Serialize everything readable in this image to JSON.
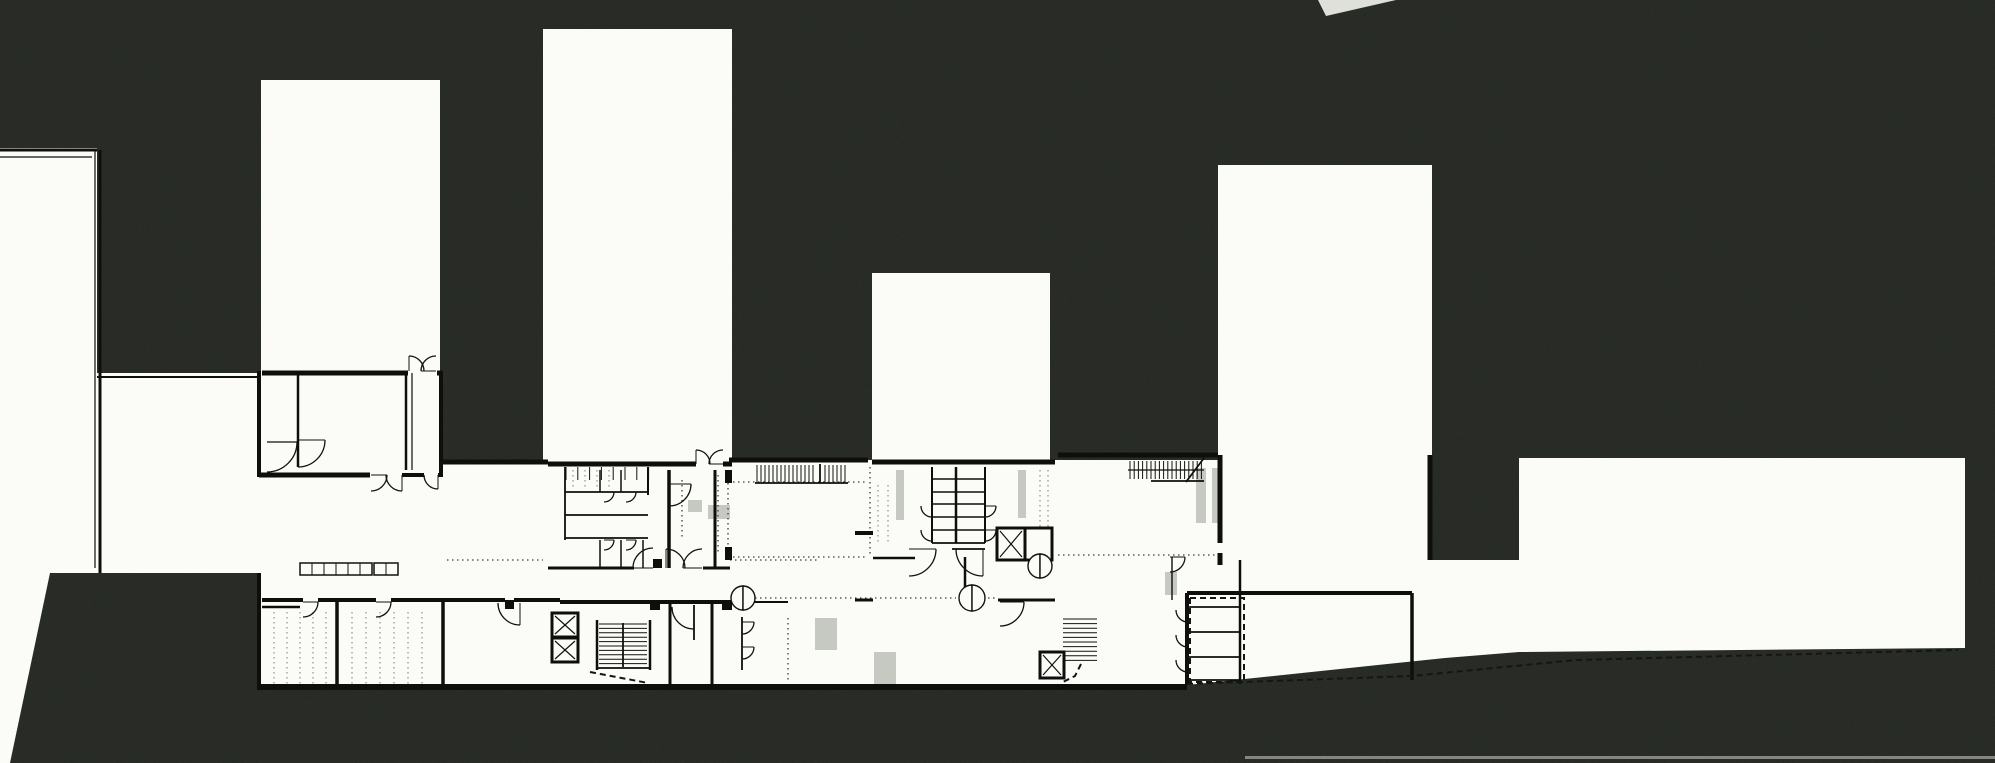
{
  "meta": {
    "canvas": {
      "width": 1995,
      "height": 763
    },
    "drawing_type": "architectural-site-floor-plan"
  },
  "palette": {
    "background": "#31352f",
    "paper": "#fbfbf7",
    "line": "#111310",
    "wall": "#0e0f0d",
    "dotted": "#3c3e39",
    "dotted_light": "#8f928a",
    "gray_fixture": "#c6c9c2",
    "dashed": "#151613",
    "notch": "#dfe0d9",
    "scanline": "#9a9d95"
  },
  "plan": {
    "masses": [
      {
        "name": "left-neighbor-building",
        "pts": [
          [
            0,
            148
          ],
          [
            97,
            148
          ],
          [
            97,
            373
          ],
          [
            259,
            373
          ],
          [
            259,
            573
          ],
          [
            50,
            573
          ],
          [
            10,
            763
          ],
          [
            0,
            763
          ]
        ]
      },
      {
        "name": "tower-1-with-wing",
        "pts": [
          [
            261,
            80
          ],
          [
            440,
            80
          ],
          [
            440,
            371
          ],
          [
            443,
            371
          ],
          [
            443,
            477
          ],
          [
            258,
            477
          ],
          [
            258,
            371
          ],
          [
            261,
            371
          ]
        ]
      },
      {
        "name": "tower-2",
        "rect": [
          543,
          29,
          189,
          433
        ]
      },
      {
        "name": "tower-3",
        "rect": [
          872,
          273,
          178,
          189
        ]
      },
      {
        "name": "tower-4",
        "rect": [
          1218,
          165,
          214,
          395
        ]
      },
      {
        "name": "ground-floor-band",
        "pts": [
          [
            258,
            477
          ],
          [
            443,
            477
          ],
          [
            443,
            460
          ],
          [
            1432,
            460
          ],
          [
            1432,
            560
          ],
          [
            1519,
            560
          ],
          [
            1519,
            652
          ],
          [
            1445,
            658
          ],
          [
            1187,
            685
          ],
          [
            258,
            690
          ]
        ]
      },
      {
        "name": "right-low-building",
        "pts": [
          [
            1519,
            458
          ],
          [
            1965,
            458
          ],
          [
            1965,
            648
          ],
          [
            1519,
            652
          ]
        ]
      }
    ],
    "gray_fixtures": [
      [
        896,
        470,
        8,
        50
      ],
      [
        1018,
        470,
        8,
        48
      ],
      [
        1165,
        572,
        12,
        23
      ],
      [
        1196,
        468,
        10,
        55
      ],
      [
        1212,
        468,
        10,
        55
      ],
      [
        815,
        618,
        22,
        32
      ],
      [
        874,
        652,
        22,
        32
      ],
      [
        688,
        500,
        14,
        12
      ],
      [
        708,
        505,
        22,
        14
      ]
    ],
    "dotted_light": [
      [
        274,
        612,
        274,
        685
      ],
      [
        287,
        612,
        287,
        685
      ],
      [
        300,
        612,
        300,
        685
      ],
      [
        313,
        612,
        313,
        685
      ],
      [
        326,
        612,
        326,
        685
      ],
      [
        352,
        612,
        352,
        685
      ],
      [
        366,
        612,
        366,
        685
      ],
      [
        380,
        612,
        380,
        685
      ],
      [
        394,
        612,
        394,
        685
      ],
      [
        408,
        612,
        408,
        685
      ],
      [
        422,
        612,
        422,
        685
      ],
      [
        878,
        485,
        878,
        545
      ],
      [
        888,
        485,
        888,
        545
      ],
      [
        1040,
        470,
        1040,
        545
      ],
      [
        1048,
        470,
        1048,
        545
      ],
      [
        573,
        470,
        573,
        488
      ],
      [
        585,
        470,
        585,
        488
      ],
      [
        597,
        470,
        597,
        488
      ],
      [
        609,
        470,
        609,
        488
      ]
    ],
    "dotted": [
      [
        447,
        560,
        543,
        560
      ],
      [
        733,
        557,
        868,
        557
      ],
      [
        733,
        482,
        868,
        482
      ],
      [
        1058,
        555,
        1218,
        555
      ],
      [
        755,
        598,
        956,
        598
      ],
      [
        988,
        598,
        998,
        598
      ],
      [
        682,
        480,
        682,
        537
      ],
      [
        718,
        475,
        718,
        555
      ],
      [
        728,
        483,
        728,
        547
      ],
      [
        870,
        467,
        870,
        556
      ],
      [
        788,
        618,
        788,
        682
      ],
      [
        730,
        560,
        820,
        560
      ]
    ],
    "walls": [
      [
        262,
        373,
        408,
        373,
        5
      ],
      [
        437,
        373,
        443,
        373,
        5
      ],
      [
        259,
        371,
        259,
        477,
        4
      ],
      [
        259,
        475,
        370,
        475,
        5
      ],
      [
        402,
        475,
        424,
        475,
        4
      ],
      [
        438,
        475,
        443,
        475,
        4
      ],
      [
        298,
        373,
        298,
        467,
        2.5
      ],
      [
        406,
        373,
        406,
        470,
        2.5
      ],
      [
        412,
        373,
        412,
        470,
        1.2
      ],
      [
        441,
        371,
        441,
        477,
        4
      ],
      [
        97,
        377,
        259,
        377,
        2
      ],
      [
        0,
        150,
        97,
        150,
        3
      ],
      [
        0,
        157,
        92,
        157,
        1.2
      ],
      [
        95,
        150,
        95,
        568,
        1.2
      ],
      [
        100,
        150,
        100,
        573,
        3
      ],
      [
        259,
        573,
        259,
        690,
        4
      ],
      [
        262,
        600,
        303,
        600,
        4
      ],
      [
        318,
        600,
        376,
        600,
        4
      ],
      [
        391,
        600,
        505,
        600,
        4
      ],
      [
        514,
        600,
        560,
        600,
        4
      ],
      [
        337,
        600,
        337,
        687,
        3.5
      ],
      [
        443,
        600,
        443,
        687,
        3.5
      ],
      [
        262,
        607,
        300,
        607,
        2.5
      ],
      [
        259,
        687,
        1187,
        687,
        6
      ],
      [
        548,
        464,
        696,
        464,
        5
      ],
      [
        723,
        464,
        732,
        464,
        5
      ],
      [
        443,
        462,
        548,
        462,
        5
      ],
      [
        729,
        460,
        868,
        460,
        5
      ],
      [
        872,
        462,
        1055,
        462,
        5
      ],
      [
        1058,
        455,
        1218,
        455,
        5
      ],
      [
        1220,
        455,
        1220,
        543,
        5
      ],
      [
        1220,
        553,
        1220,
        565,
        5
      ],
      [
        1430,
        455,
        1430,
        560,
        5
      ],
      [
        548,
        568,
        634,
        568,
        3
      ],
      [
        703,
        568,
        730,
        568,
        3
      ],
      [
        669,
        470,
        669,
        568,
        3.5
      ],
      [
        715,
        470,
        715,
        568,
        3
      ],
      [
        648,
        467,
        648,
        495,
        2
      ],
      [
        621,
        470,
        621,
        492,
        1.5
      ],
      [
        600,
        470,
        600,
        492,
        1.5
      ],
      [
        565,
        467,
        565,
        540,
        1.8
      ],
      [
        565,
        492,
        648,
        492,
        1.8
      ],
      [
        565,
        515,
        648,
        515,
        1.8
      ],
      [
        565,
        538,
        648,
        538,
        1.8
      ],
      [
        600,
        540,
        600,
        568,
        1.5
      ],
      [
        621,
        540,
        621,
        568,
        1.5
      ],
      [
        643,
        540,
        643,
        568,
        1.5
      ],
      [
        956,
        467,
        956,
        543,
        2.5
      ],
      [
        932,
        467,
        932,
        543,
        2
      ],
      [
        985,
        467,
        985,
        543,
        2
      ],
      [
        932,
        479,
        985,
        479,
        1.4
      ],
      [
        932,
        492,
        985,
        492,
        1.4
      ],
      [
        932,
        504,
        985,
        504,
        1.4
      ],
      [
        932,
        517,
        985,
        517,
        1.4
      ],
      [
        932,
        530,
        985,
        530,
        1.4
      ],
      [
        932,
        543,
        985,
        543,
        1.8
      ],
      [
        873,
        558,
        915,
        558,
        2.5
      ],
      [
        952,
        549,
        985,
        549,
        1.8
      ],
      [
        855,
        600,
        873,
        600,
        3
      ],
      [
        998,
        600,
        1055,
        600,
        3
      ],
      [
        560,
        602,
        650,
        602,
        4
      ],
      [
        660,
        602,
        722,
        602,
        4
      ],
      [
        734,
        602,
        788,
        602,
        2
      ],
      [
        1187,
        593,
        1412,
        593,
        4
      ],
      [
        1187,
        593,
        1187,
        685,
        4
      ],
      [
        1240,
        560,
        1240,
        684,
        2.5
      ],
      [
        1412,
        593,
        1412,
        680,
        3.5
      ],
      [
        1188,
        607,
        1240,
        607,
        1.8
      ],
      [
        1188,
        632,
        1240,
        632,
        1.8
      ],
      [
        1188,
        657,
        1240,
        657,
        1.8
      ],
      [
        1188,
        680,
        1240,
        680,
        1.8
      ],
      [
        597,
        620,
        597,
        670,
        2.5
      ],
      [
        650,
        620,
        650,
        670,
        2.5
      ],
      [
        623,
        623,
        623,
        667,
        1.8
      ],
      [
        597,
        668,
        650,
        668,
        1.8
      ],
      [
        670,
        602,
        670,
        687,
        3
      ],
      [
        694,
        605,
        694,
        640,
        1.8
      ],
      [
        712,
        602,
        712,
        687,
        3
      ],
      [
        742,
        617,
        742,
        670,
        1.8
      ],
      [
        1151,
        481,
        1204,
        481,
        1.8
      ],
      [
        1128,
        470,
        1204,
        470,
        1.2
      ],
      [
        1186,
        482,
        1204,
        458,
        1.8
      ],
      [
        755,
        483,
        848,
        483,
        1.8
      ],
      [
        820,
        464,
        820,
        483,
        1.8
      ],
      [
        855,
        533,
        873,
        533,
        4
      ],
      [
        1172,
        557,
        1172,
        600,
        1.4
      ],
      [
        965,
        557,
        965,
        600,
        2.5
      ],
      [
        267,
        442,
        297,
        442,
        1.2
      ],
      [
        298,
        440,
        298,
        467,
        1.2
      ]
    ],
    "combs": [
      {
        "name": "stair-run",
        "x": 757,
        "y": 465,
        "step": 4,
        "count": 15,
        "len": 17,
        "dir": "v"
      },
      {
        "name": "stair-run",
        "x": 825,
        "y": 465,
        "step": 4,
        "count": 6,
        "len": 17,
        "dir": "v"
      },
      {
        "name": "stair-run",
        "x": 1130,
        "y": 461,
        "step": 4.2,
        "count": 18,
        "len": 18,
        "dir": "v"
      },
      {
        "name": "stair-treads",
        "x": 599,
        "y": 624,
        "step": 4.4,
        "count": 10,
        "len": 48,
        "dir": "h"
      },
      {
        "name": "stair-treads",
        "x": 1063,
        "y": 619,
        "step": 4.6,
        "count": 10,
        "len": 34,
        "dir": "h"
      },
      {
        "name": "stall-partition-ticks",
        "x": 566,
        "y": 467,
        "step": 11.8,
        "count": 8,
        "len": 13,
        "dir": "v"
      }
    ],
    "door_arcs": [
      [
        409,
        371,
        15,
        -90,
        0
      ],
      [
        436,
        371,
        15,
        180,
        270
      ],
      [
        371,
        475,
        16,
        0,
        90
      ],
      [
        402,
        475,
        16,
        90,
        180
      ],
      [
        438,
        475,
        14,
        90,
        180
      ],
      [
        298,
        440,
        27,
        0,
        90
      ],
      [
        267,
        442,
        30,
        0,
        90
      ],
      [
        696,
        464,
        14,
        -90,
        0
      ],
      [
        723,
        464,
        14,
        180,
        270
      ],
      [
        669,
        484,
        22,
        0,
        90
      ],
      [
        909,
        549,
        27,
        0,
        90
      ],
      [
        983,
        549,
        27,
        90,
        180
      ],
      [
        1170,
        557,
        15,
        0,
        90
      ],
      [
        1000,
        602,
        24,
        0,
        90
      ],
      [
        303,
        602,
        15,
        0,
        90
      ],
      [
        376,
        602,
        15,
        0,
        90
      ],
      [
        666,
        568,
        19,
        -90,
        0
      ],
      [
        702,
        568,
        19,
        180,
        270
      ],
      [
        653,
        568,
        20,
        180,
        270
      ],
      [
        604,
        492,
        10,
        0,
        90
      ],
      [
        626,
        492,
        10,
        0,
        90
      ],
      [
        604,
        540,
        10,
        0,
        90
      ],
      [
        626,
        540,
        10,
        0,
        90
      ],
      [
        932,
        506,
        11,
        90,
        180
      ],
      [
        932,
        530,
        11,
        90,
        180
      ],
      [
        985,
        506,
        11,
        0,
        90
      ],
      [
        985,
        530,
        11,
        0,
        90
      ],
      [
        1188,
        610,
        12,
        90,
        180
      ],
      [
        1188,
        635,
        12,
        90,
        180
      ],
      [
        1188,
        660,
        12,
        90,
        180
      ],
      [
        742,
        622,
        12,
        0,
        90
      ],
      [
        742,
        647,
        12,
        0,
        90
      ],
      [
        694,
        607,
        22,
        90,
        180
      ],
      [
        520,
        603,
        22,
        90,
        180
      ]
    ],
    "bowtie_doors": [
      [
        743,
        598,
        12
      ],
      [
        972,
        598,
        13
      ],
      [
        1040,
        566,
        12
      ]
    ],
    "elevators": [
      {
        "x": 552,
        "y": 613,
        "w": 26,
        "h": 24,
        "cross": true
      },
      {
        "x": 552,
        "y": 638,
        "w": 26,
        "h": 24,
        "cross": true
      },
      {
        "x": 997,
        "y": 528,
        "w": 28,
        "h": 32,
        "cross": true
      },
      {
        "x": 1025,
        "y": 528,
        "w": 27,
        "h": 32,
        "cross": false
      },
      {
        "x": 1040,
        "y": 652,
        "w": 24,
        "h": 26,
        "cross": true
      }
    ],
    "lockers": [
      {
        "x": 300,
        "y": 563,
        "w": 72,
        "h": 12,
        "cells": 6
      },
      {
        "x": 374,
        "y": 563,
        "w": 24,
        "h": 12,
        "cells": 2
      }
    ],
    "columns": [
      [
        650,
        600,
        10,
        10
      ],
      [
        722,
        600,
        10,
        10
      ],
      [
        505,
        600,
        9,
        9
      ],
      [
        653,
        559,
        9,
        9
      ],
      [
        725,
        470,
        7,
        13
      ],
      [
        725,
        547,
        7,
        13
      ]
    ],
    "dashed_edges": [
      [
        [
          1187,
          684
        ],
        [
          1412,
          676
        ],
        [
          1576,
          660
        ],
        [
          1958,
          650
        ]
      ],
      [
        [
          590,
          672
        ],
        [
          648,
          683
        ]
      ],
      [
        [
          1190,
          598
        ],
        [
          1244,
          598
        ],
        [
          1244,
          682
        ],
        [
          1190,
          682
        ],
        [
          1190,
          598
        ]
      ],
      [
        [
          1081,
          664
        ],
        [
          1075,
          676
        ],
        [
          1063,
          682
        ]
      ]
    ],
    "artifacts": [
      {
        "name": "page-edge-notch",
        "pts": [
          [
            1318,
            0
          ],
          [
            1396,
            0
          ],
          [
            1326,
            16
          ]
        ]
      },
      {
        "name": "scan-line",
        "rect": [
          1245,
          756,
          750,
          3
        ]
      }
    ]
  }
}
